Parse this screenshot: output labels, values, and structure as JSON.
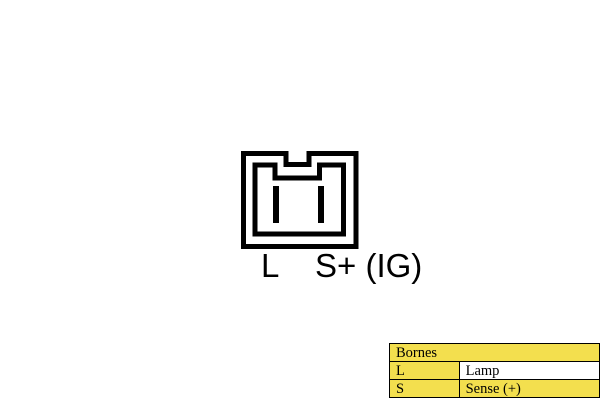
{
  "connector_diagram": {
    "pin_labels": [
      "L",
      "S+ (IG)"
    ],
    "pin_count": 2,
    "outline_color": "#000000"
  },
  "legend_table": {
    "title": "Bornes",
    "rows": [
      {
        "terminal": "L",
        "description": "Lamp"
      },
      {
        "terminal": "S",
        "description": "Sense (+)"
      }
    ],
    "highlight_color": "#F3DF4E",
    "plain_color": "#FFFFFF",
    "border_color": "#000000"
  }
}
